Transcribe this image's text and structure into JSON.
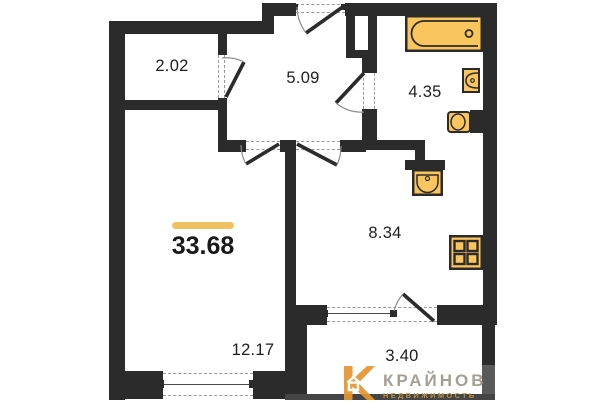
{
  "plan": {
    "total_area": {
      "value": "33.68"
    },
    "rooms": [
      {
        "id": "closet",
        "area": "2.02"
      },
      {
        "id": "hallway",
        "area": "5.09"
      },
      {
        "id": "bathroom",
        "area": "4.35"
      },
      {
        "id": "kitchen",
        "area": "8.34"
      },
      {
        "id": "living-room",
        "area": "12.17"
      },
      {
        "id": "balcony",
        "area": "3.40"
      }
    ],
    "fixtures": [
      "bathtub-icon",
      "sink-icon",
      "toilet-icon",
      "washbasin-icon",
      "stove-icon"
    ],
    "colors": {
      "wall": "#2b2b2b",
      "fixture_fill": "#fbc55d",
      "accent_bar": "#efc163"
    }
  },
  "watermark": {
    "brand": "КРАЙНОВ",
    "tagline": "НЕДВИЖИМОСТЬ"
  }
}
